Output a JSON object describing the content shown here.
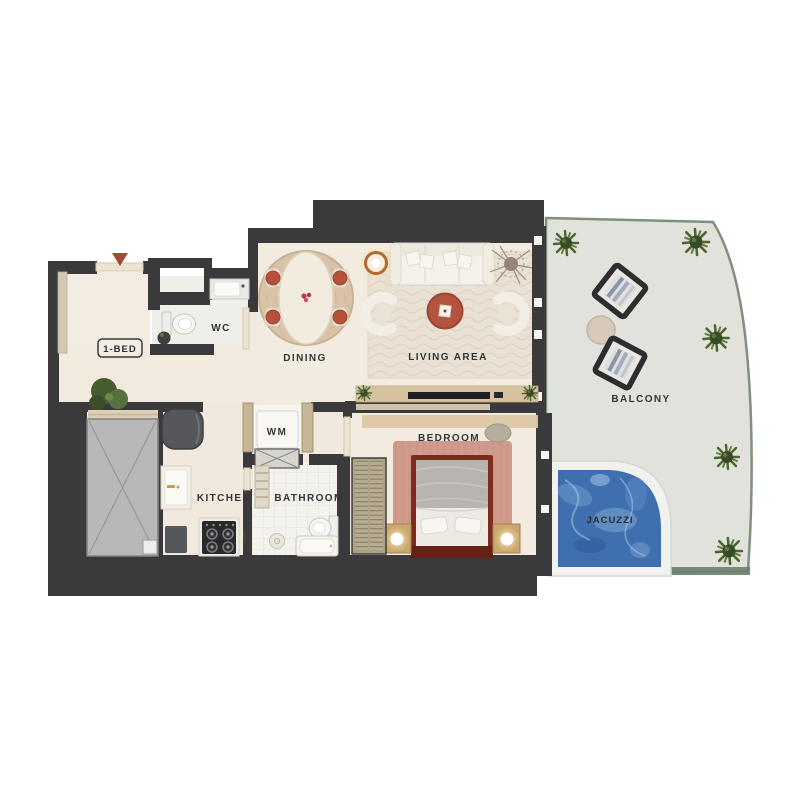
{
  "title": "1-bed apartment floor plan",
  "unit": {
    "badge": "1-BED"
  },
  "rooms": {
    "entry": {
      "label": "1-BED"
    },
    "wc": {
      "label": "WC"
    },
    "dining": {
      "label": "DINING"
    },
    "living": {
      "label": "LIVING AREA"
    },
    "bedroom": {
      "label": "BEDROOM"
    },
    "kitchen": {
      "label": "KITCHEN"
    },
    "bathroom": {
      "label": "BATHROOM"
    },
    "wm": {
      "label": "WM"
    },
    "balcony": {
      "label": "BALCONY"
    },
    "jacuzzi": {
      "label": "JACUZZI"
    }
  },
  "icons": {
    "entry_marker": "red-triangle-entry-arrow",
    "plant": "potted-plant",
    "shaft_cross": "service-shaft-x",
    "lamp": "glowing-floor-lamp"
  },
  "colors": {
    "wall": "#3a3a3c",
    "floor": "#f2ebe0",
    "balcony_floor": "#e2e2dc",
    "glass_rail": "#7d917f",
    "water": "#3f6fae",
    "accent_terracotta": "#b5503c",
    "bed_frame": "#7c2b1d",
    "wood": "#d6c29c",
    "entry_marker": "#a84a31"
  }
}
